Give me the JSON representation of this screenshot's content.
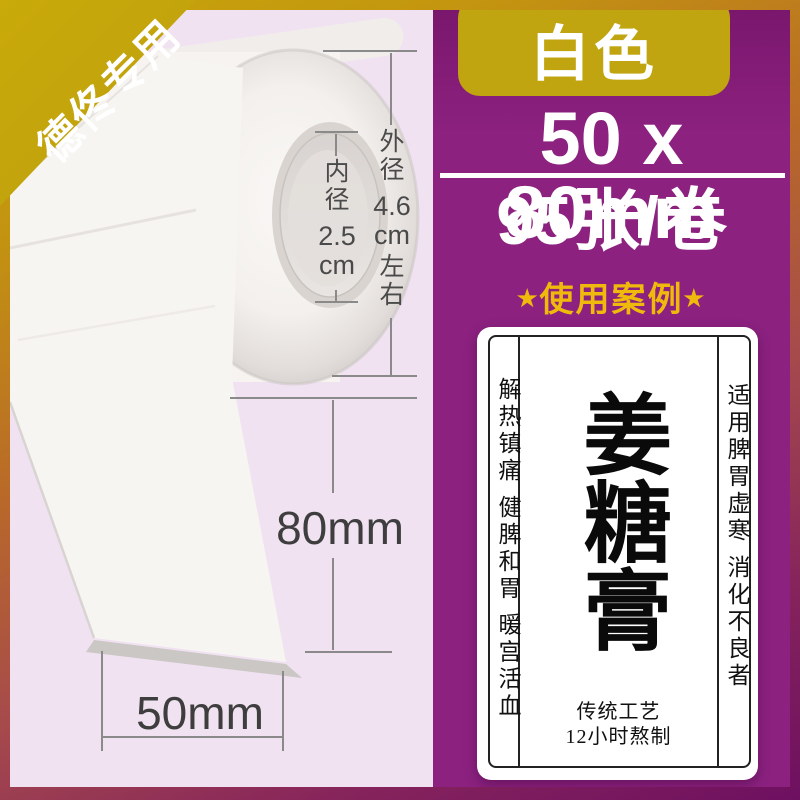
{
  "ribbon": {
    "text": "德佟专用"
  },
  "dimensions": {
    "outer": {
      "label": "外径",
      "value": "4.6",
      "unit": "cm",
      "approx": "左右"
    },
    "inner": {
      "label": "内径",
      "value": "2.5",
      "unit": "cm"
    },
    "height": "80mm",
    "width": "50mm"
  },
  "panel": {
    "badge": "白色",
    "size": "50 x 80mm",
    "count": "95张/卷",
    "case_star": "★",
    "case_text": "使用案例"
  },
  "label_example": {
    "left": "解热镇痛 健脾和胃 暖宫活血",
    "title": "姜糖膏",
    "right": "适用脾胃虚寒 消化不良者",
    "footer1": "传统工艺",
    "footer2": "12小时熬制"
  },
  "colors": {
    "gold": "#C0A511",
    "star_gold": "#F0BA0C",
    "purple": "#8C2180",
    "lavender": "#F1E2F2"
  }
}
